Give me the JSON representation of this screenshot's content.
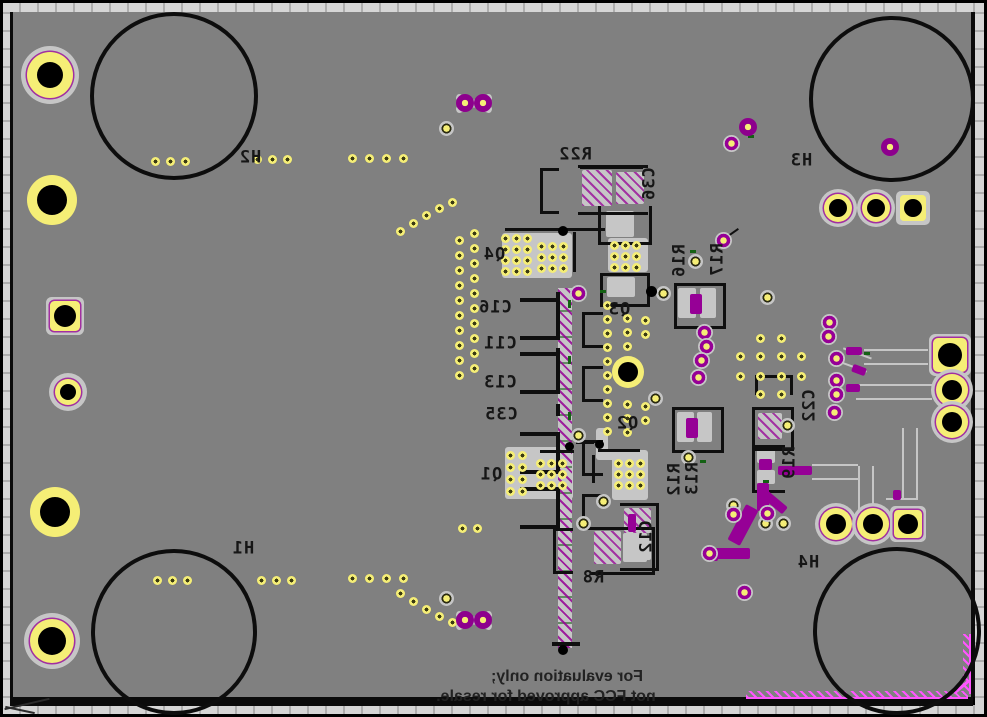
{
  "board": {
    "notice": {
      "line1": "For evaluation only;",
      "line2": "not FCC approved for resale."
    },
    "labels": {
      "h1": "H1",
      "h2": "H2",
      "h3": "H3",
      "h4": "H4",
      "q1": "Q1",
      "q2": "Q2",
      "q3": "Q3",
      "q4": "Q4",
      "c11": "C11",
      "c12": "C12",
      "c13": "C13",
      "c16": "C16",
      "c22": "C22",
      "c35": "C35",
      "c36": "C36",
      "r8": "R8",
      "r12": "R12",
      "r13": "R13",
      "r16": "R16",
      "r17": "R17",
      "r19": "R19",
      "r22": "R22"
    },
    "colors": {
      "board_gray": "#808080",
      "copper_pad_gray": "#c6c6c6",
      "solder_yellow": "#f5ee76",
      "plane_magenta": "#960096",
      "keepout_pink": "#ff55ff",
      "silkscreen_black": "#161616",
      "drill_black": "#000000",
      "ruler_gray": "#d6d6d6"
    }
  }
}
